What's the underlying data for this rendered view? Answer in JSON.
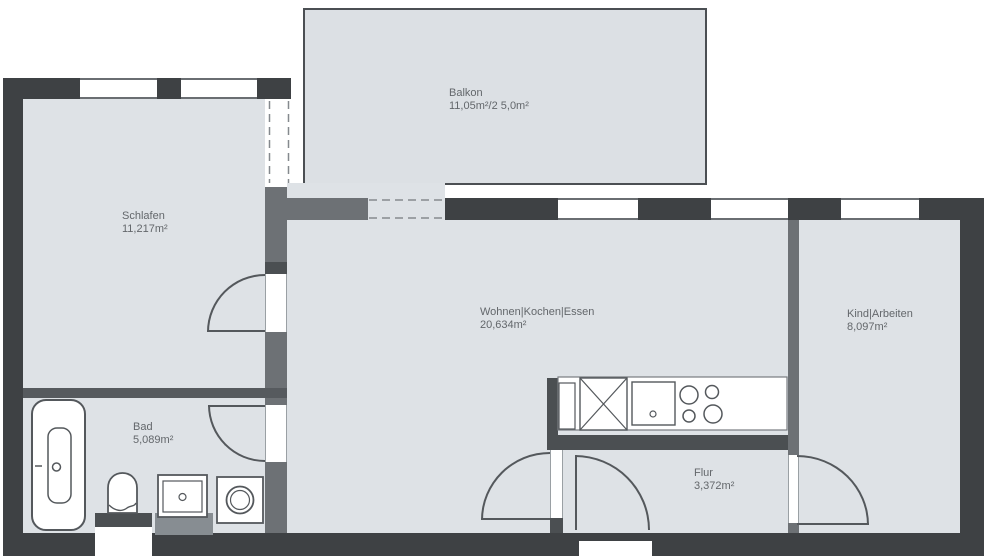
{
  "plan_title": "apartment-floor-plan",
  "rooms": [
    {
      "id": "balkon",
      "name": "Balkon",
      "area": "11,05m²/2 5,0m²"
    },
    {
      "id": "schlafen",
      "name": "Schlafen",
      "area": "11,217m²"
    },
    {
      "id": "wohnen",
      "name": "Wohnen|Kochen|Essen",
      "area": "20,634m²"
    },
    {
      "id": "kind",
      "name": "Kind|Arbeiten",
      "area": "8,097m²"
    },
    {
      "id": "bad",
      "name": "Bad",
      "area": "5,089m²"
    },
    {
      "id": "flur",
      "name": "Flur",
      "area": "3,372m²"
    }
  ],
  "fixtures": [
    "bathtub-icon",
    "toilet-icon",
    "washbasin-icon",
    "washing-machine-icon",
    "kitchen-counter-icon",
    "refrigerator-icon",
    "kitchen-sink-icon",
    "cooktop-icon"
  ],
  "colors": {
    "outer_wall": "#3e4144",
    "interior_wall": "#6d7175",
    "accent_wall": "#4b4f52",
    "floor": "#dee2e6",
    "balcony_floor": "#dce0e4",
    "fixture_stroke": "#54585c",
    "text": "#63676b"
  }
}
